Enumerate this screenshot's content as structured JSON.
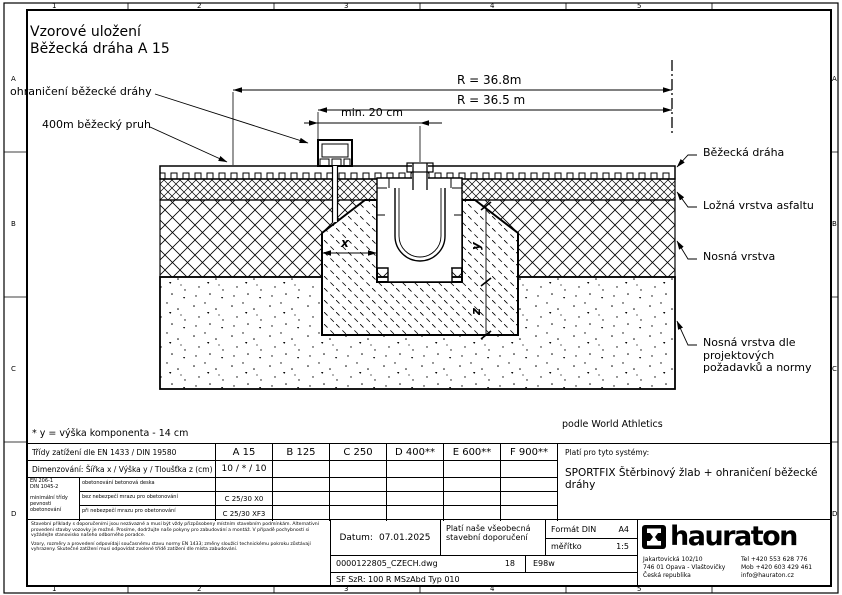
{
  "frame": {
    "cols": [
      "1",
      "2",
      "3",
      "4",
      "5"
    ],
    "rows": [
      "A",
      "B",
      "C",
      "D"
    ]
  },
  "title": {
    "line1": "Vzorové uložení",
    "line2": "Běžecká dráha A 15"
  },
  "drawing": {
    "dim_r_outer": "R = 36.8m",
    "dim_r_inner": "R = 36.5 m",
    "dim_min": "min. 20 cm",
    "dim_x": "x",
    "dim_y": "y",
    "dim_z": "z",
    "label_edge": "ohraničení běžecké dráhy",
    "label_lane": "400m běžecký pruh",
    "label_track": "Běžecká dráha",
    "label_asphalt": "Ložná vrstva asfaltu",
    "label_base": "Nosná vrstva",
    "label_subbase": "Nosná vrstva dle projektových požadavků a normy",
    "footnote": "* y = výška komponenta - 14 cm",
    "standard": "podle World Athletics"
  },
  "table": {
    "load_header": "Třídy zatížení dle EN 1433 / DIN 19580",
    "classes": [
      "A 15",
      "B 125",
      "C 250",
      "D 400**",
      "E 600**",
      "F 900**"
    ],
    "dim_label": "Dimenzování:  Šířka x / Výška y / Tloušťka z (cm)",
    "dim_value": "10 / * / 10",
    "concrete": {
      "norm1": "EN 206-1",
      "norm2": "DIN 1045-2",
      "norm_note": "minimální třídy pevnosti obetonování",
      "rows": [
        {
          "label": "obetonování betonová deska",
          "value": ""
        },
        {
          "label": "bez nebezpečí mrazu pro obetonování",
          "value": "C 25/30 X0"
        },
        {
          "label": "při nebezpečí mrazu pro obetonování",
          "value": "C 25/30 XF3"
        }
      ]
    },
    "systems_header": "Platí pro tyto systémy:",
    "systems_value": "SPORTFIX  Štěrbinový žlab + ohraničení běžecké dráhy"
  },
  "titleblock": {
    "disclaimer1": "Stavební příklady s doporučeními jsou nezávazné a musí být vždy přizpůsobeny místním stavebním podmínkám. Alternativní provedení stavby vozovky je možné. Prosíme, dodržujte naše pokyny pro zabudování a montáž. V případě pochybností si vyžádejte stanovisko našeho odborného poradce.",
    "disclaimer2": "Vzory, rozměry a provedení odpovídají současnému stavu normy EN 1433; změny sloužící technickému pokroku zůstávají vyhrazeny. Skutečné zatížení musí odpovídat zvolené třídě zatížení dle místa zabudování.",
    "date_label": "Datum:",
    "date": "07.01.2025",
    "note_line1": "Platí naše všeobecná",
    "note_line2": "stavební doporučení",
    "format_label": "Formát DIN",
    "format_value": "A4",
    "scale_label": "měřítko",
    "scale_value": "1:5",
    "file": "0000122805_CZECH.dwg",
    "sheet": "18",
    "code": "E98w",
    "system_code": "SF SzR:  100 R MSzAbd Typ 010",
    "company": {
      "name": "hauraton",
      "address": [
        "Jakartovická 102/10",
        "746 01 Opava - Vlaštovičky",
        "Česká republika"
      ],
      "contacts": [
        "Tel  +420 553 628 776",
        "Mob  +420 603 429 461",
        "info@hauraton.cz"
      ]
    }
  }
}
